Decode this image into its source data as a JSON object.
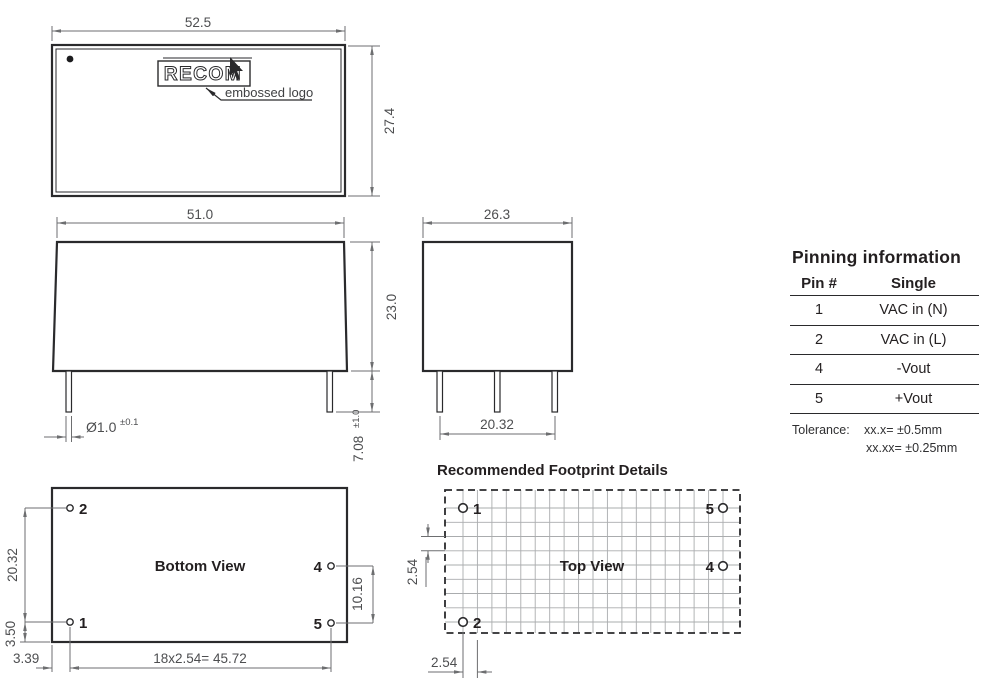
{
  "colors": {
    "outline": "#2a2a2c",
    "dimension": "#6d6e70",
    "dim_text": "#4d4e50",
    "grid": "#aaacae"
  },
  "top_view": {
    "width_dim": "52.5",
    "height_dim": "27.4",
    "logo_text": "RECOM",
    "logo_caption": "embossed logo"
  },
  "front_view": {
    "width_dim": "51.0",
    "height_dim": "23.0",
    "pin_dia": "Ø1.0",
    "pin_dia_tol": "±0.1",
    "pin_len": "7.08",
    "pin_len_tol": "±1.0"
  },
  "side_view": {
    "width_dim": "26.3",
    "pin_span_dim": "20.32"
  },
  "pinning": {
    "title": "Pinning information",
    "col_pin": "Pin #",
    "col_single": "Single",
    "rows": [
      {
        "pin": "1",
        "single": "VAC in (N)"
      },
      {
        "pin": "2",
        "single": "VAC in (L)"
      },
      {
        "pin": "4",
        "single": "-Vout"
      },
      {
        "pin": "5",
        "single": "+Vout"
      }
    ],
    "tolerance_label": "Tolerance:",
    "tolerance_line1": "xx.x= ±0.5mm",
    "tolerance_line2": "xx.xx= ±0.25mm"
  },
  "bottom_view": {
    "title": "Bottom View",
    "pins": {
      "p1": "1",
      "p2": "2",
      "p4": "4",
      "p5": "5"
    },
    "dim_pin_span_v": "20.32",
    "dim_edge_v": "3.50",
    "dim_edge_h": "3.39",
    "dim_pitch_row": "18x2.54= 45.72",
    "dim_out_span_v": "10.16"
  },
  "footprint": {
    "title": "Recommended Footprint Details",
    "view_label": "Top View",
    "pins": {
      "p1": "1",
      "p2": "2",
      "p4": "4",
      "p5": "5"
    },
    "dim_grid_v": "2.54",
    "dim_grid_h": "2.54"
  }
}
